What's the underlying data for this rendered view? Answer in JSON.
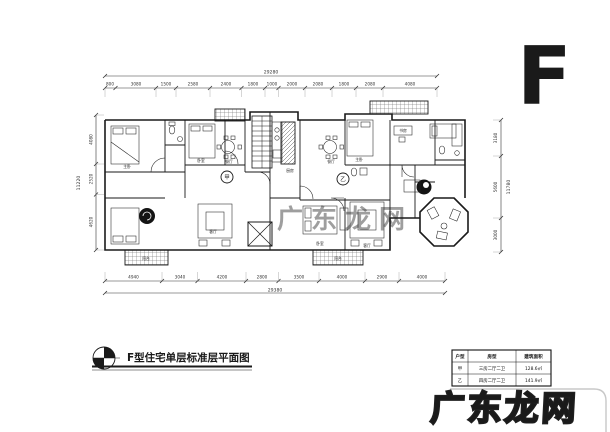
{
  "letter_mark": "F",
  "title": {
    "text": "F型住宅单层标准层平面图"
  },
  "watermark": {
    "bottom_text": "广东龙网",
    "center_text": "广东龙网"
  },
  "dimensions": {
    "top": {
      "total": "29280",
      "segments": [
        "800",
        "3080",
        "1500",
        "2580",
        "2400",
        "1800",
        "1000",
        "2000",
        "2080",
        "1800",
        "2080",
        "4080"
      ]
    },
    "bottom": {
      "total": "29380",
      "segments": [
        "4940",
        "3040",
        "4200",
        "2800",
        "3500",
        "4000",
        "2900",
        "4000"
      ]
    },
    "left": {
      "total": "11220",
      "segments": [
        "4080",
        "2520",
        "4620"
      ]
    },
    "right": {
      "total": "11780",
      "segments": [
        "3180",
        "5600",
        "3000"
      ]
    }
  },
  "units": [
    {
      "label": "甲"
    },
    {
      "label": "乙"
    }
  ],
  "rooms": [
    "主卧",
    "卧室",
    "餐厅",
    "厨房",
    "客厅",
    "餐厅",
    "主卧",
    "客厅",
    "卧室",
    "阳台",
    "阳台",
    "书房"
  ],
  "area_table": {
    "headers": [
      "户型",
      "房型",
      "建筑面积"
    ],
    "rows": [
      [
        "甲",
        "三房二厅二卫",
        "128.6㎡"
      ],
      [
        "乙",
        "四房二厅二卫",
        "141.9㎡"
      ]
    ]
  },
  "colors": {
    "line": "#1a1a1a",
    "dim": "#333333",
    "faint_frame": "#c8c8c8",
    "watermark_stroke": "#1f1f1f",
    "watermark_fill": "#ffffff",
    "center_watermark": "#cfcfcf"
  }
}
